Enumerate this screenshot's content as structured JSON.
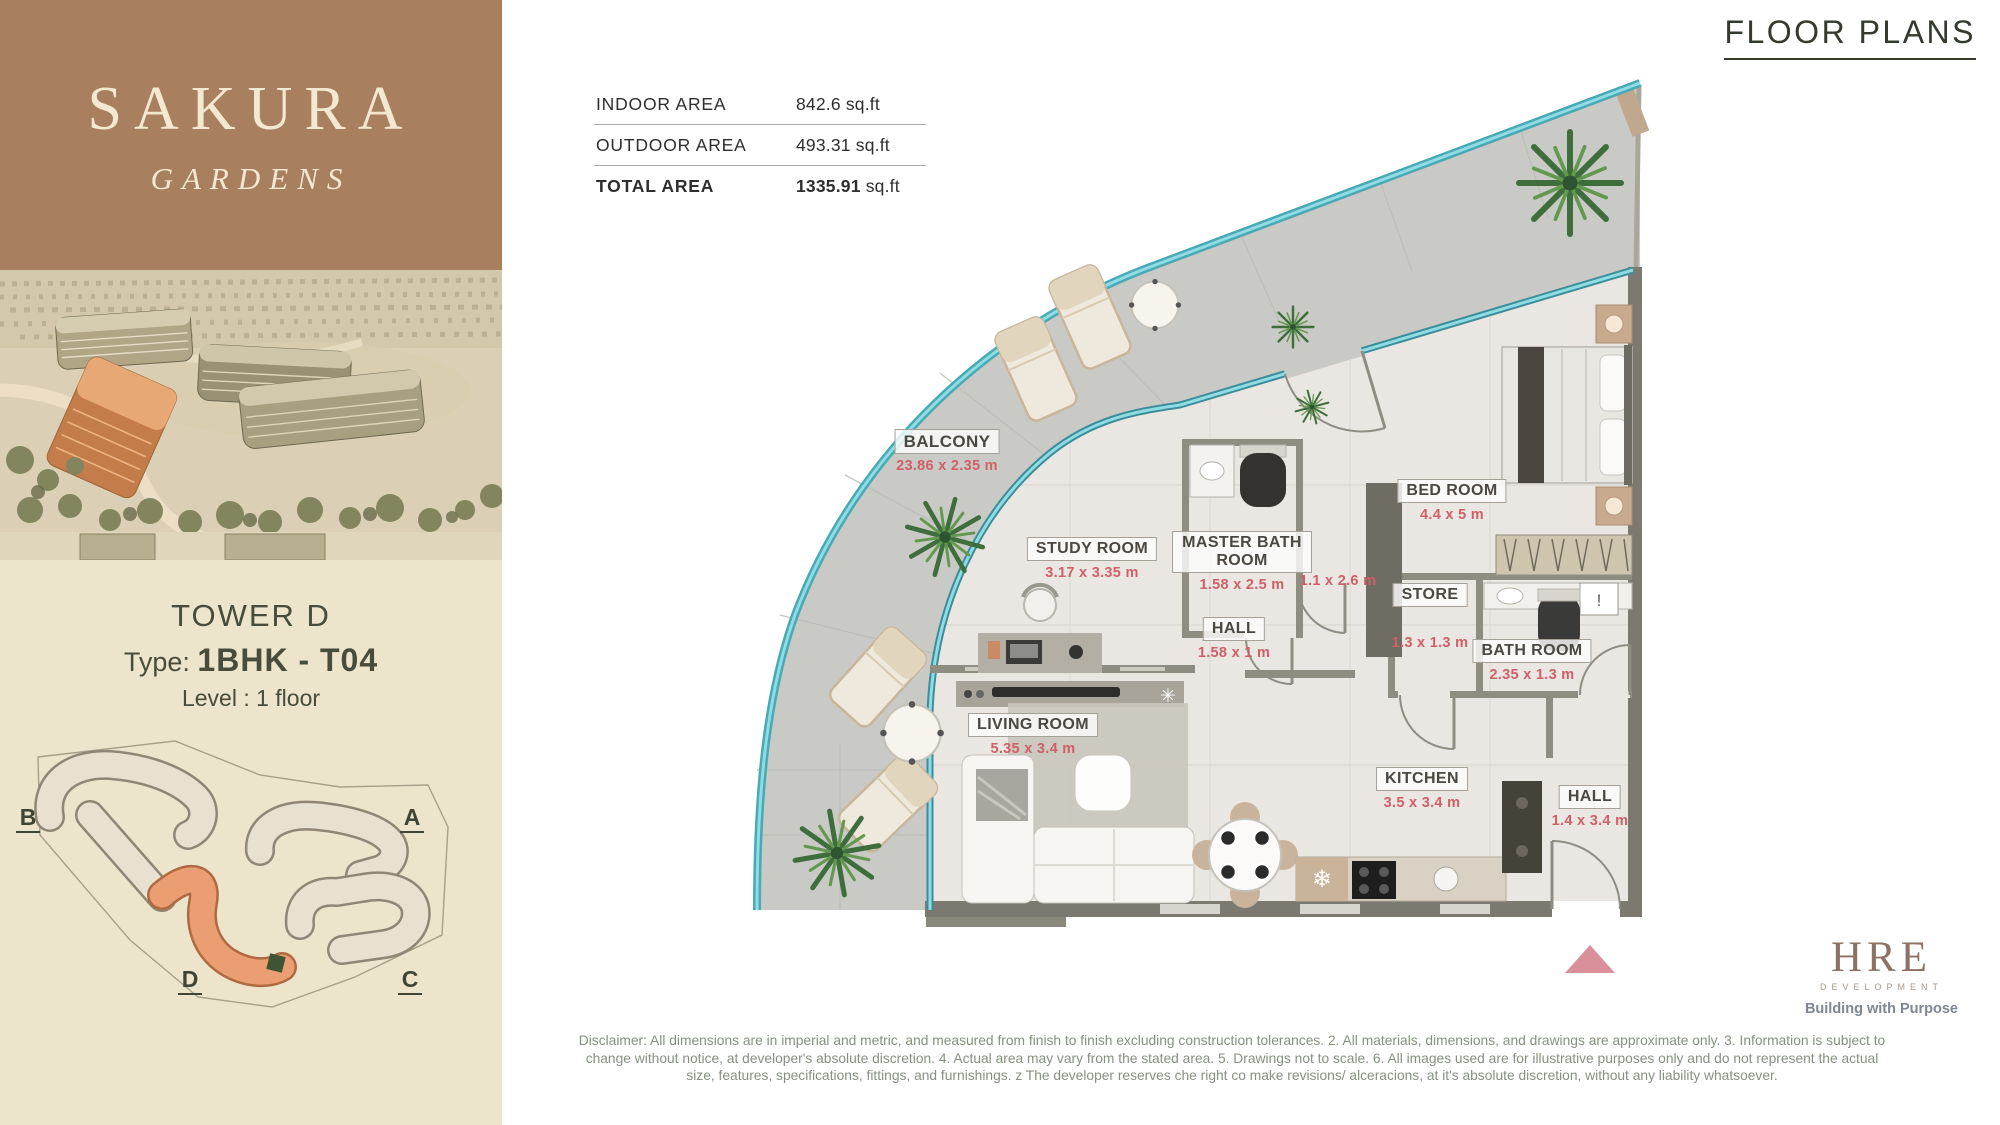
{
  "brand": {
    "name": "SAKURA",
    "subname": "GARDENS"
  },
  "header": {
    "title": "FLOOR PLANS"
  },
  "area_table": {
    "rows": [
      {
        "label": "INDOOR AREA",
        "value": "842.6",
        "unit": "sq.ft"
      },
      {
        "label": "OUTDOOR AREA",
        "value": "493.31",
        "unit": "sq.ft"
      },
      {
        "label": "TOTAL AREA",
        "value": "1335.91",
        "unit": "sq.ft"
      }
    ]
  },
  "unit_info": {
    "tower": "TOWER D",
    "type_label": "Type:",
    "type_value": "1BHK - T04",
    "level_label": "Level :",
    "level_value": "1 floor"
  },
  "site_plan": {
    "towers": {
      "a": "A",
      "b": "B",
      "c": "C",
      "d": "D"
    },
    "highlighted": "D",
    "highlight_color": "#eb9e72"
  },
  "floor_plan": {
    "balcony": {
      "name": "BALCONY",
      "dims": "23.86 x 2.35 m"
    },
    "study": {
      "name": "STUDY ROOM",
      "dims": "3.17 x 3.35 m"
    },
    "master_bath": {
      "name": "MASTER BATH ROOM",
      "dims": "1.58 x 2.5 m"
    },
    "bedroom": {
      "name": "BED ROOM",
      "dims": "4.4 x 5 m"
    },
    "hall_center": {
      "name": "HALL",
      "dims": "1.58 x 1 m"
    },
    "corridor": {
      "dims": "1.1 x 2.6 m"
    },
    "store": {
      "name": "STORE",
      "dims": "1.3 x 1.3 m"
    },
    "bathroom": {
      "name": "BATH ROOM",
      "dims": "2.35 x 1.3 m"
    },
    "living": {
      "name": "LIVING ROOM",
      "dims": "5.35 x 3.4 m"
    },
    "kitchen": {
      "name": "KITCHEN",
      "dims": "3.5 x 3.4 m"
    },
    "hall_entry": {
      "name": "HALL",
      "dims": "1.4 x 3.4 m"
    }
  },
  "icons": {
    "fridge": "❄",
    "fan": "✳",
    "alert": "!"
  },
  "footer": {
    "logo": {
      "name": "HRE",
      "sub": "DEVELOPMENT",
      "tagline": "Building with Purpose"
    },
    "disclaimer": "Disclaimer: All dimensions are in imperial and metric, and measured from finish to finish excluding construction tolerances. 2. All materials, dimensions, and drawings are approximate only. 3. Information is subject to change without notice, at developer's absolute discretion. 4. Actual area may vary from the stated area. 5. Drawings not to scale. 6. All images used are for illustrative purposes only and do not represent the actual size, features, specifications, fittings, and furnishings. z The developer reserves che right co make revisions/ alceracions, at it's absolute discretion, without any liability whatsoever."
  },
  "colors": {
    "brand_bg": "#a8805f",
    "cream": "#ece4cb",
    "accent_red": "#cf5f68",
    "teal_rail": "#49a9b5",
    "wall": "#8f8c82",
    "entry_marker": "#d9909b",
    "text_dark": "#3f4534",
    "disclaimer_text": "#85917f"
  }
}
